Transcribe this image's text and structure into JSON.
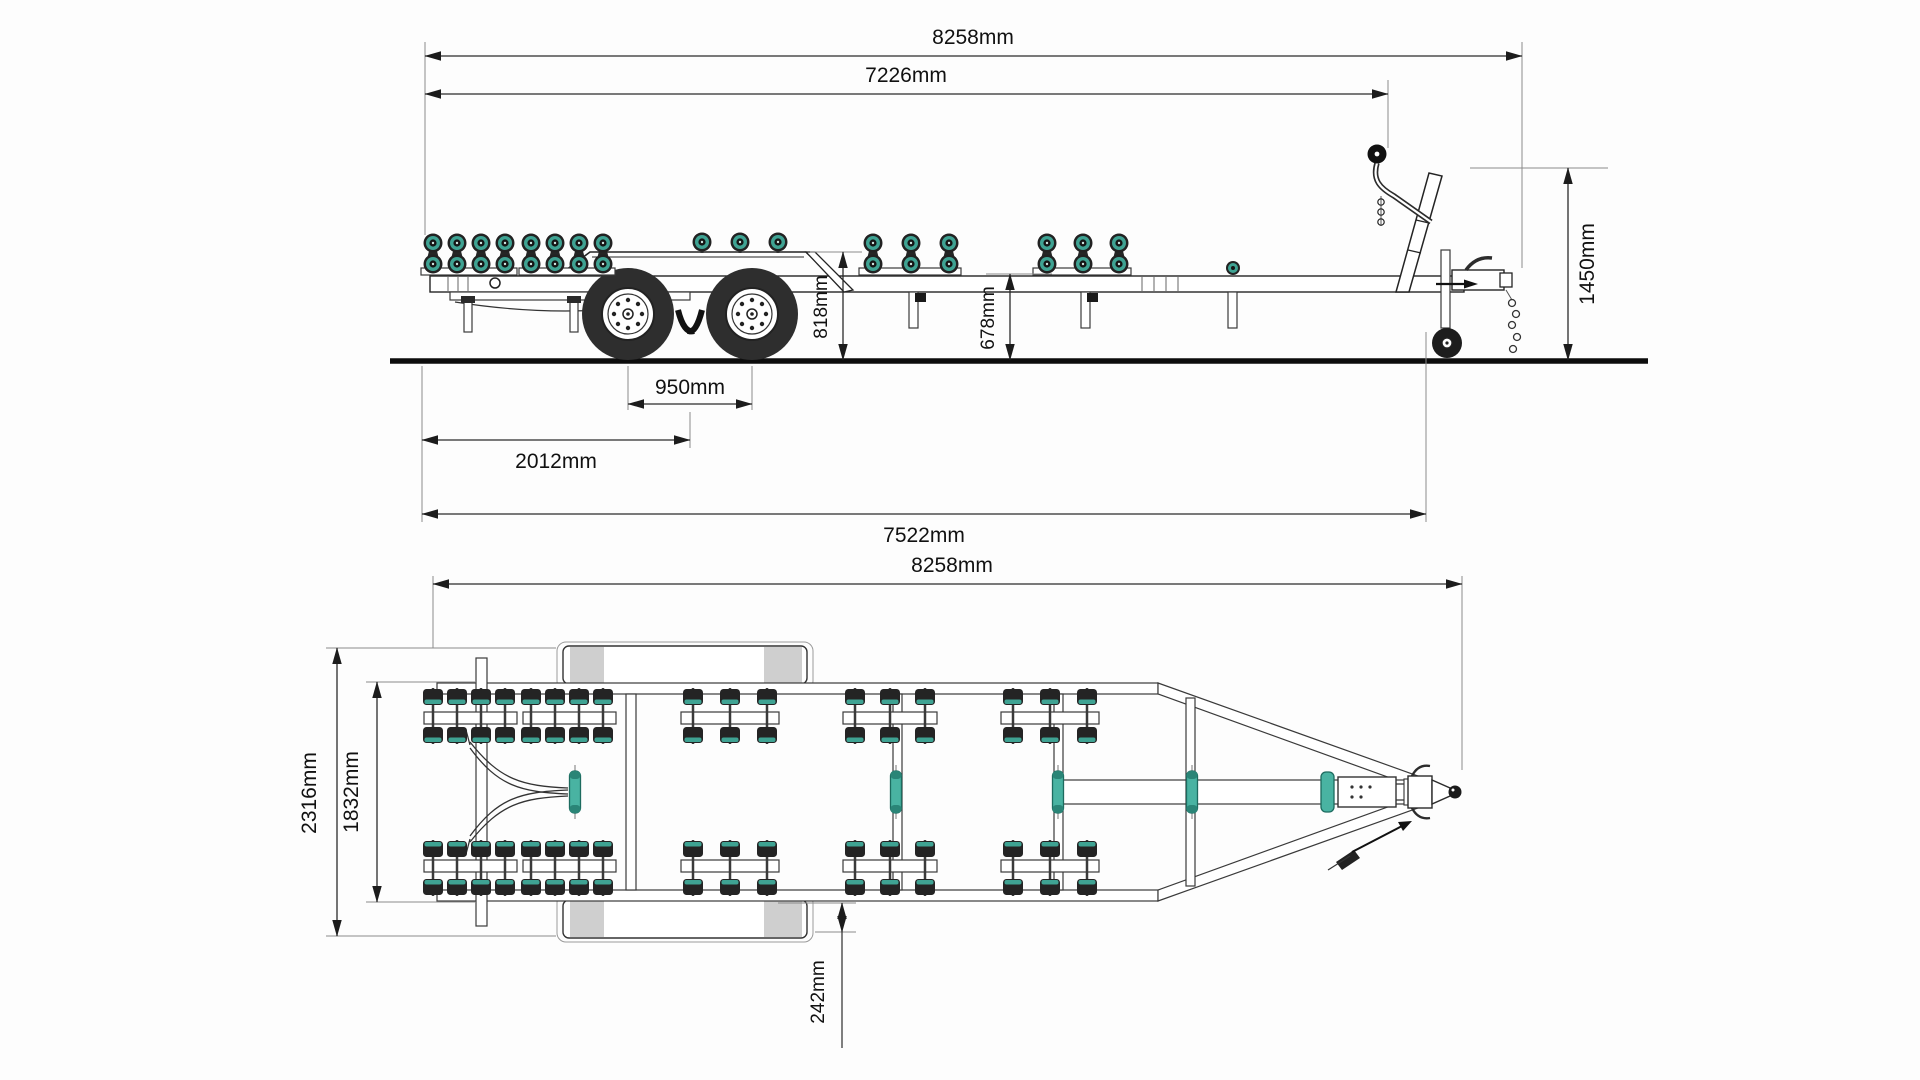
{
  "drawing_title": "boat trailer dimensioned drawing",
  "side_view": {
    "label": "side view",
    "dims": {
      "overall_length": "8258mm",
      "body_length": "7226mm",
      "overall_height": "1450mm",
      "rear_frame_height": "818mm",
      "main_frame_height": "678mm",
      "axle_spacing": "950mm",
      "rear_overhang": "2012mm",
      "chassis_length": "7522mm"
    }
  },
  "top_view": {
    "label": "top view",
    "dims": {
      "overall_length": "8258mm",
      "overall_width": "2316mm",
      "bed_width": "1832mm",
      "fender_offset": "242mm"
    }
  },
  "colors": {
    "roller_accent": "#3fa393",
    "roller_accent_dark": "#1d6b5f",
    "tire": "#2e2e2e",
    "line": "#1c1c1c",
    "fender_gray": "#cfcfcf"
  }
}
